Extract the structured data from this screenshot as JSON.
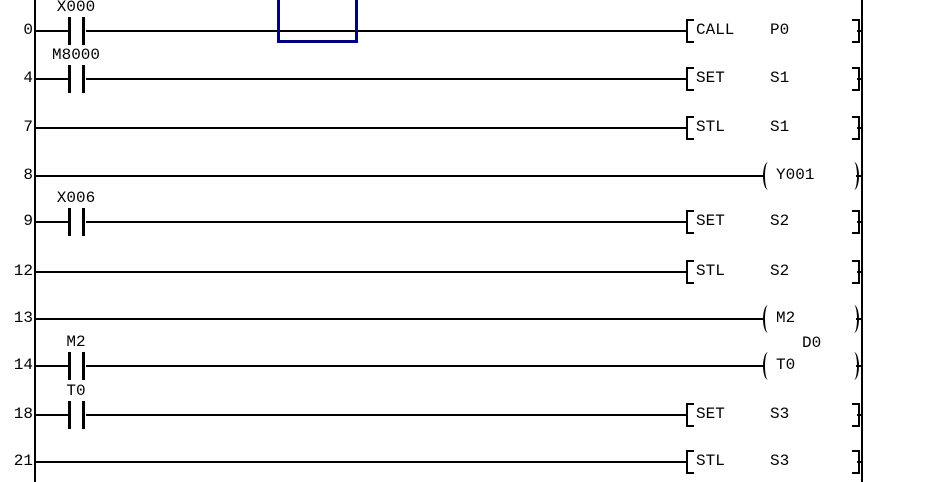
{
  "editor": {
    "kind": "plc-ladder-diagram",
    "colors": {
      "background": "#ffffff",
      "wire": "#000000",
      "cursor": "#000080",
      "text": "#000000"
    }
  },
  "rungs": [
    {
      "step": "0",
      "contact": "X000",
      "type": "box",
      "instruction": "CALL",
      "operand": "P0"
    },
    {
      "step": "4",
      "contact": "M8000",
      "type": "box",
      "instruction": "SET",
      "operand": "S1"
    },
    {
      "step": "7",
      "type": "box",
      "instruction": "STL",
      "operand": "S1"
    },
    {
      "step": "8",
      "type": "coil",
      "coil": "Y001"
    },
    {
      "step": "9",
      "contact": "X006",
      "type": "box",
      "instruction": "SET",
      "operand": "S2"
    },
    {
      "step": "12",
      "type": "box",
      "instruction": "STL",
      "operand": "S2"
    },
    {
      "step": "13",
      "type": "coil",
      "coil": "M2"
    },
    {
      "step": "14",
      "contact": "M2",
      "type": "coil",
      "coil": "T0",
      "coil_param": "D0"
    },
    {
      "step": "18",
      "contact": "T0",
      "type": "box",
      "instruction": "SET",
      "operand": "S3"
    },
    {
      "step": "21",
      "type": "box",
      "instruction": "STL",
      "operand": "S3"
    }
  ]
}
